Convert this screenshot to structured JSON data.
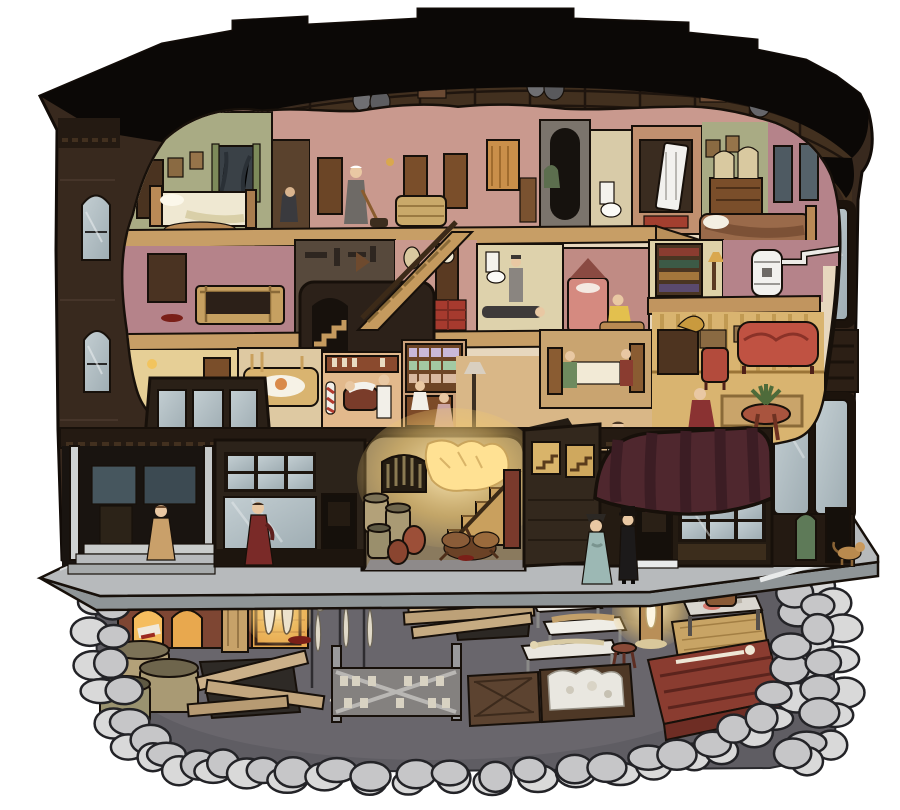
{
  "scene": {
    "title": "Cutaway illustration of a three-story Victorian brick building showing guest rooms, shops, a service alley, street figures and an excavated basement workshop",
    "style": "hand-inked isometric cross-section, muted sepia palette, no text"
  },
  "palette": {
    "background": "#ffffff",
    "roof_black": "#0b0806",
    "brick_dark": "#38291e",
    "attic_wood": "#42301f",
    "interior_cream": "#e7d7be",
    "floor_wood": "#c79e66",
    "wall_pink": "#c9998e",
    "wall_mauve": "#b5838a",
    "wall_green": "#a9ab84",
    "wall_yellow": "#e6cf96",
    "glass_blue": "#aeb9bd",
    "awning_maroon": "#4f272e",
    "awning_stripe": "#3c1d24",
    "sidewalk_gray": "#b7babc",
    "sidewalk_edge": "#8f9597",
    "stone_gray": "#d9d9d9",
    "basement_dark": "#5f5d63",
    "furnace_brick": "#7e4633",
    "furnace_glow": "#f5bd5e",
    "lamp_glow": "#ffe193",
    "blood_red": "#7a1f18",
    "sofa_red": "#c05242",
    "dress_red": "#7a2a28",
    "dress_blue": "#9cb8b4",
    "dress_yellow": "#e3c04e"
  },
  "building": {
    "attic_items": [
      "storage crates",
      "clay jugs",
      "stacked barrels",
      "trap door"
    ],
    "floor3_rooms": [
      "green bedroom with bed and window",
      "dark closet with crouching figure",
      "hallway with maid sweeping",
      "wicker trunk nook",
      "black drop chute",
      "bathroom with toilet",
      "walk-in vault with white safe door",
      "dressing room with mirrored dresser",
      "corner bedroom with large bed"
    ],
    "floor2_rooms": [
      "trunk room with open crate",
      "dark tool workshop",
      "grandfather-clock hall with plaid rug",
      "bathroom with body on floor",
      "pink bedroom with woman at trunk",
      "library shelf nook",
      "stove room with white heater and pipe",
      "hidden stairwell with stacked stairs"
    ],
    "floor1_rooms": [
      "yellow lamp room with dresser",
      "dining room with lace-set table",
      "barber shop with striped pole",
      "candy shop with shelves and clerk",
      "piano hall with grand piano and woman in gown",
      "restaurant booth",
      "parlor with gramophone, red sofa and fern"
    ],
    "ground_floor": [
      "corner porch with white posts and steps",
      "double glass storefronts",
      "recessed shop door",
      "glowing service alley with barred grate, stair and barrels",
      "stair windows in brick pier",
      "striped-awning shop",
      "rounded corner turret with arched green window"
    ]
  },
  "street": {
    "figures": [
      "woman in tan dress on porch steps",
      "woman in dark red walking dress",
      "woman in pale blue dress",
      "man in black suit and top hat",
      "small tan dog",
      "dogs fighting over scraps in the alley"
    ]
  },
  "basement": {
    "objects": [
      "brick kiln with two glowing arches",
      "lit alcove with two hanging pale bodies",
      "timber support post",
      "three lime vats",
      "plank-covered pit",
      "three hanging skeletons on stands",
      "bottle rack with cross bracing",
      "three white dissection tables with remains",
      "wooden stool",
      "tallow candle burning on a post",
      "work bench with tools and flesh",
      "crates of quicklime and bones",
      "large red wooden chest topped with bones",
      "second plank-covered pit",
      "straw mat",
      "storage barrel",
      "blood stains"
    ]
  }
}
